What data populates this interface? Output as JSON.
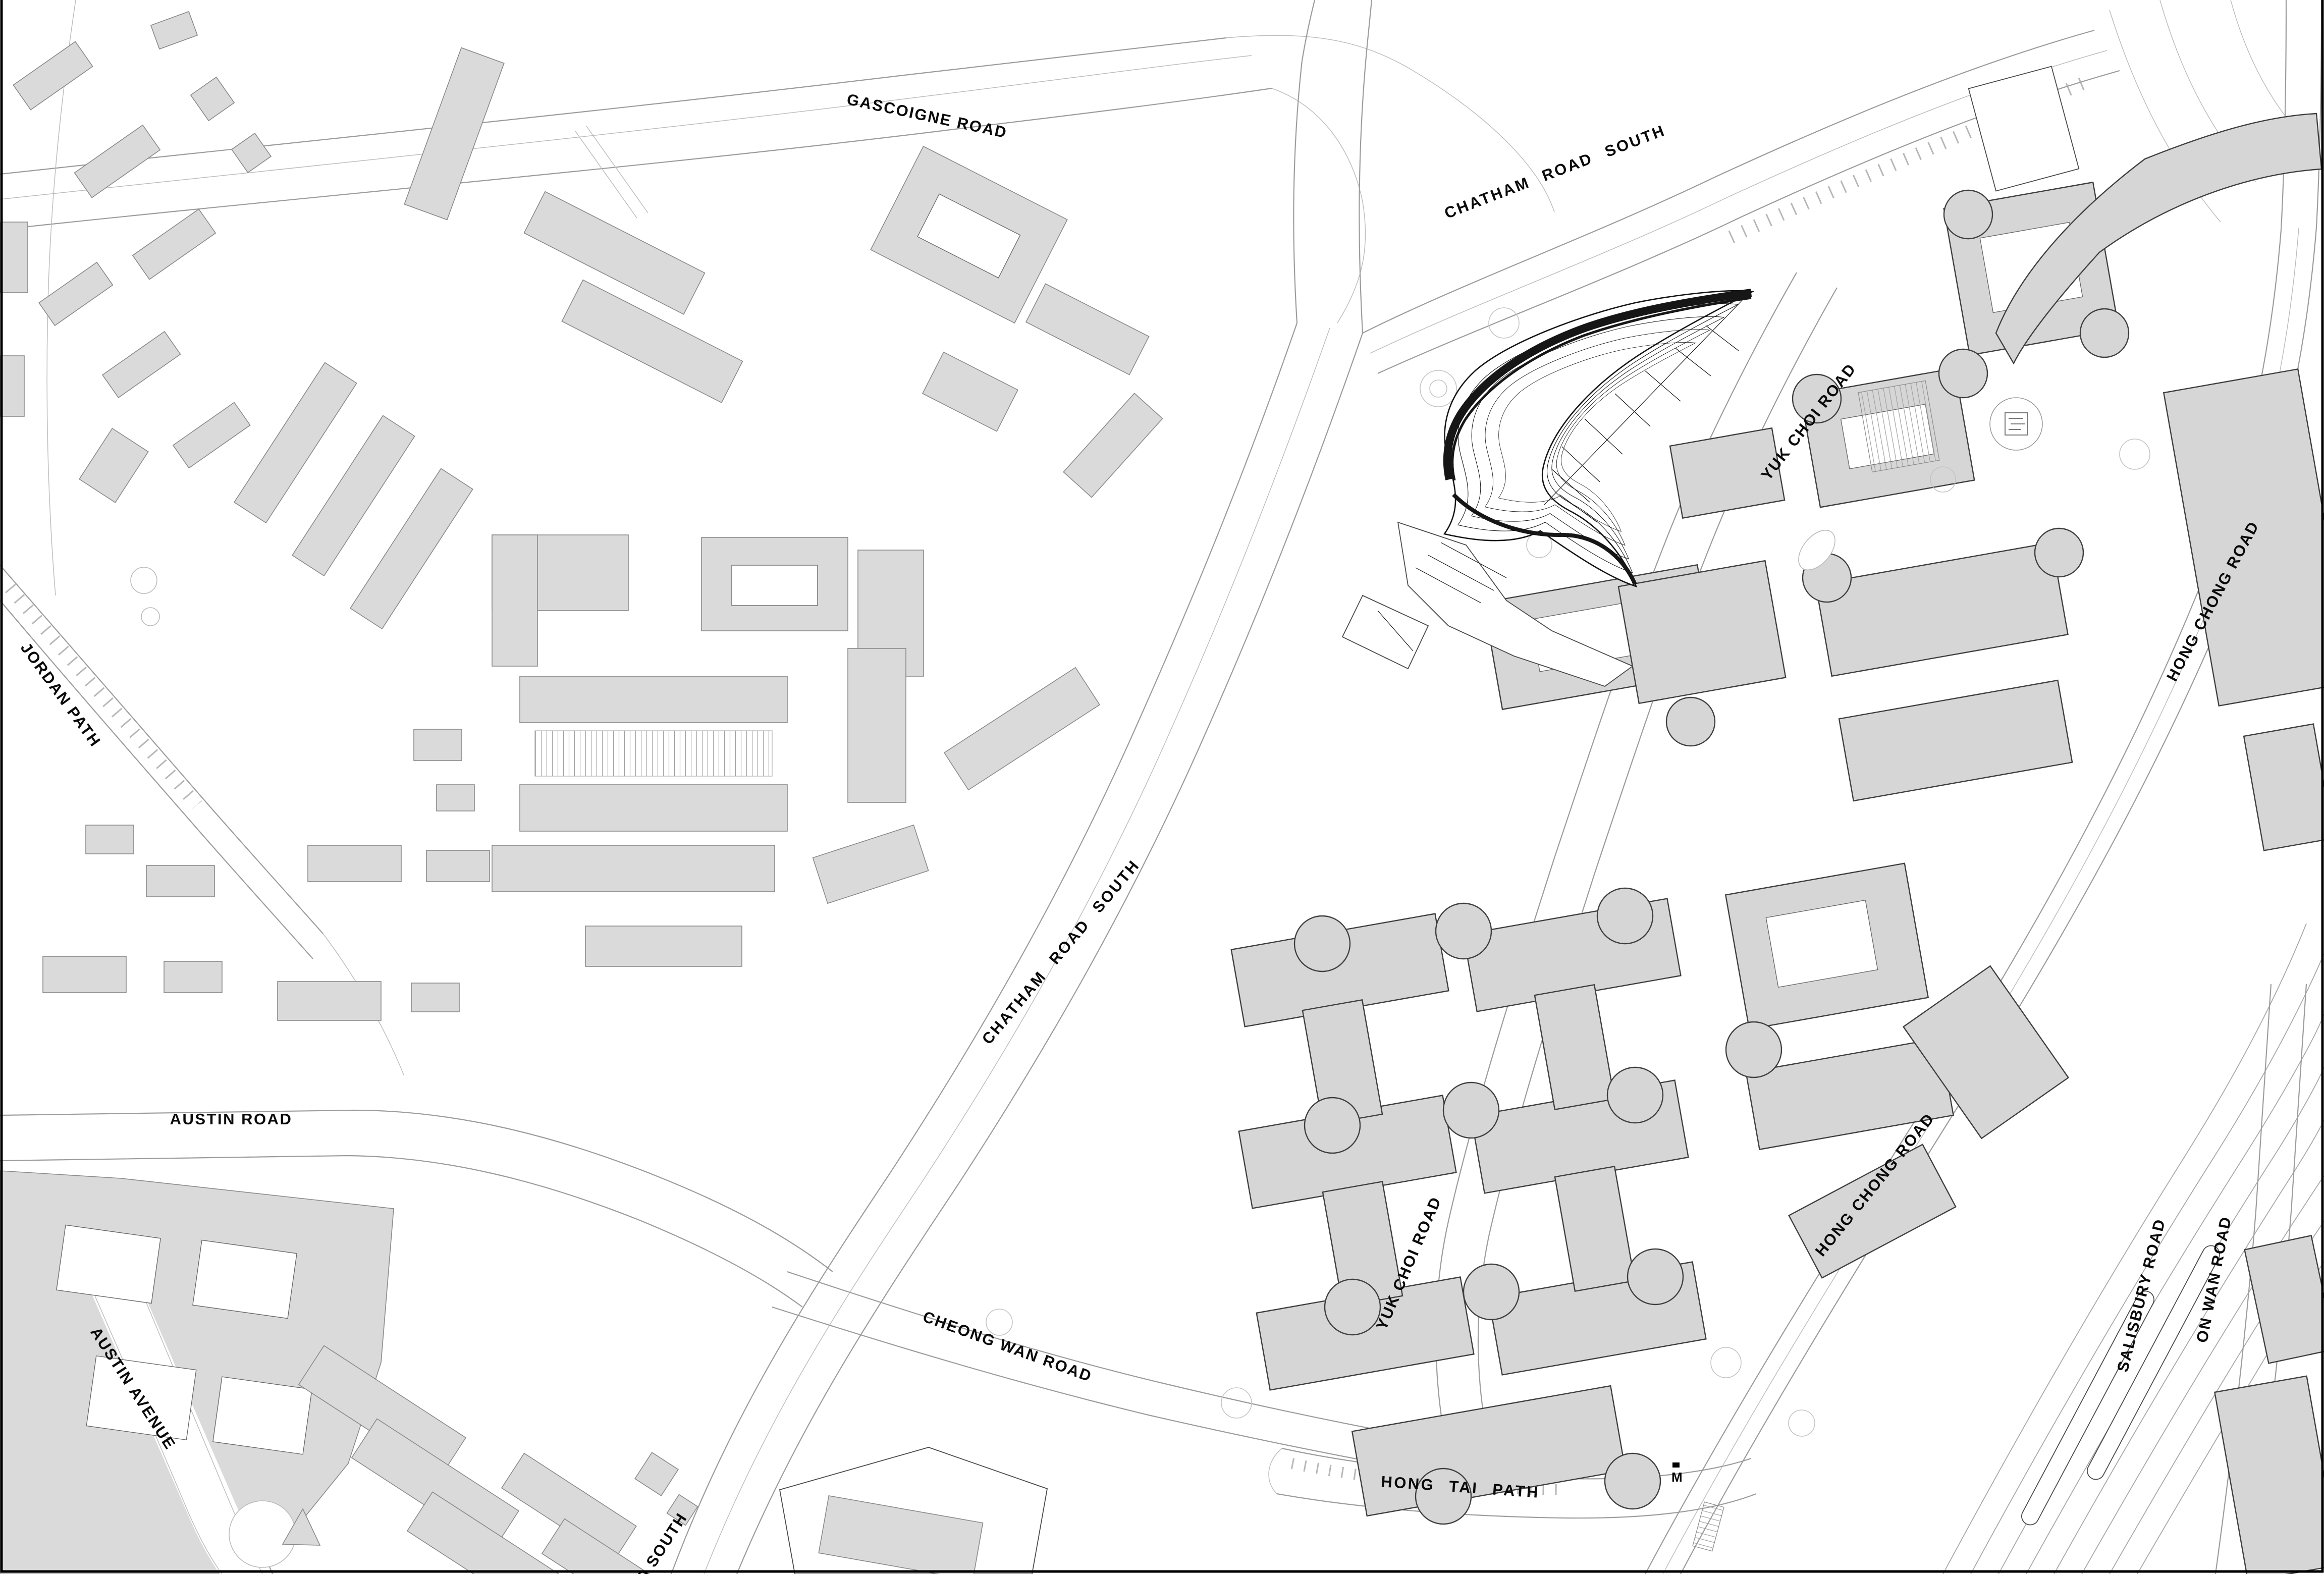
{
  "road_labels": {
    "gascoigne_road": "GASCOIGNE ROAD",
    "chatham_road_south_top": "CHATHAM ROAD SOUTH",
    "chatham_road_south_mid": "CHATHAM ROAD SOUTH",
    "chatham_road_south_fragment": "D SOUTH",
    "yuk_choi_road_north": "YUK CHOI ROAD",
    "yuk_choi_road_south": "YUK CHOI ROAD",
    "hong_chong_road_north": "HONG CHONG ROAD",
    "hong_chong_road_south": "HONG CHONG ROAD",
    "jordan_path": "JORDAN PATH",
    "austin_road": "AUSTIN ROAD",
    "austin_avenue": "AUSTIN AVENUE",
    "cheong_wan_road": "CHEONG WAN ROAD",
    "salisbury_road": "SALISBURY ROAD",
    "on_wan_road": "ON WAN ROAD",
    "hong_tai_path": "HONG TAI PATH"
  },
  "markers": {
    "station_m": "M"
  },
  "colors": {
    "background": "#ffffff",
    "building_fill": "#dadada",
    "campus_building_fill": "#d6d6d6",
    "building_stroke": "#3f3f3f",
    "road_line": "#9c9c9c",
    "label_color": "#0a0a0a",
    "tower_line": "#141414",
    "frame": "#000000"
  }
}
